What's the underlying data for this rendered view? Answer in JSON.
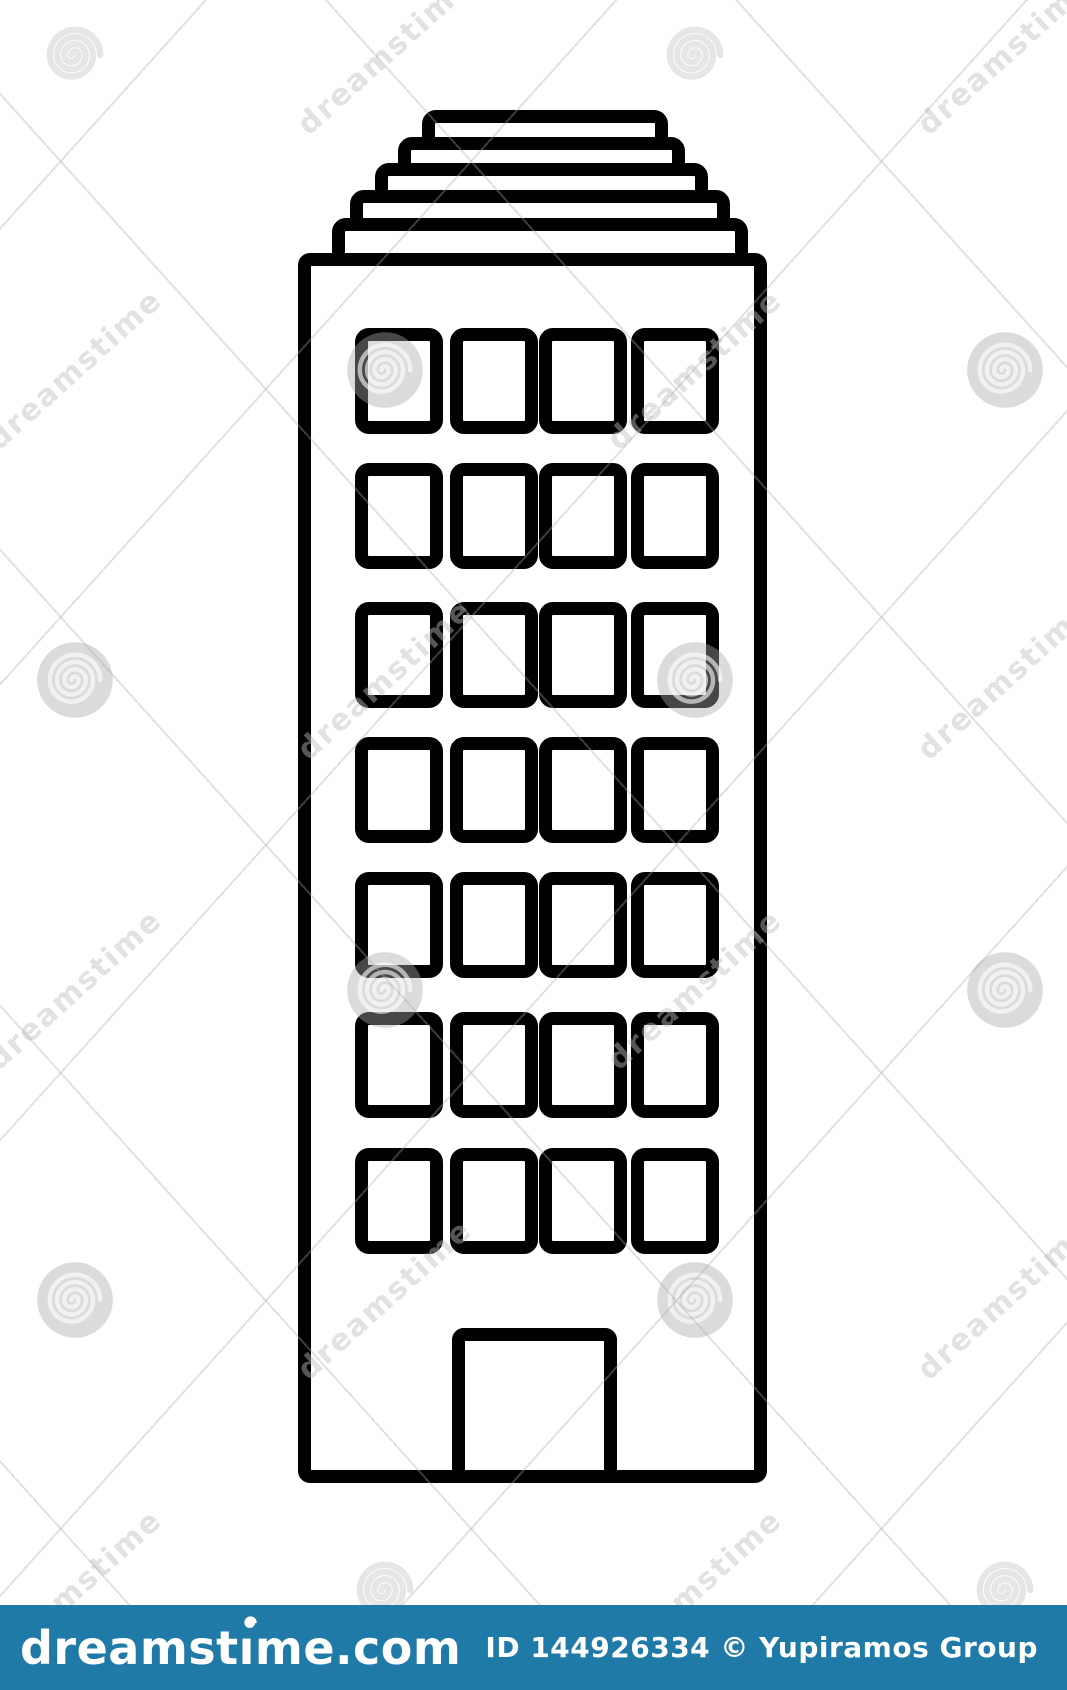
{
  "image": {
    "description": "Black and white line-art icon of a tall city building (skyscraper) with a stepped ziggurat roof, a grid of windows and a central door",
    "background_color": "#ffffff",
    "line_color": "#010101"
  },
  "building": {
    "roof_steps": 5,
    "window_rows": 7,
    "window_cols": 4,
    "has_door": true
  },
  "watermark": {
    "tile_text": "dreamstime",
    "rotation_deg": -42,
    "grid_rows_y": [
      55,
      370,
      680,
      990,
      1300,
      1590
    ],
    "grid_cols_x": [
      75,
      385,
      695,
      1005
    ]
  },
  "footer": {
    "bar_color": "#207AA8",
    "logo_text": "dreamstime.com",
    "logo_text_display": "dreamstıme.com",
    "id_text": "ID 144926334 © Yupiramos Group",
    "text_color": "#ffffff"
  }
}
